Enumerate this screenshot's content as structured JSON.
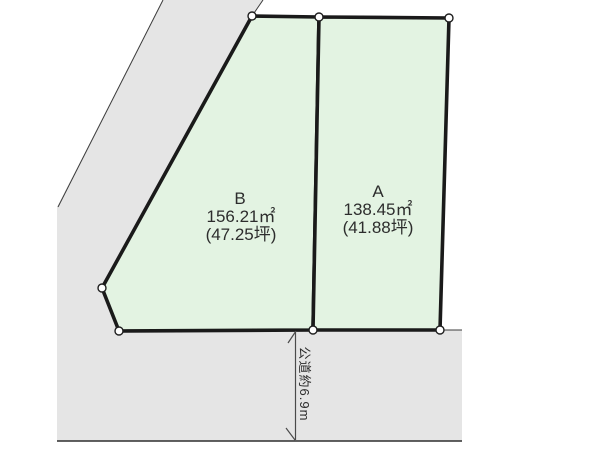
{
  "diagram": {
    "type": "land-plot-layout",
    "plots": [
      {
        "id": "B",
        "label": "B",
        "area_sqm": "156.21㎡",
        "area_tsubo": "(47.25坪)"
      },
      {
        "id": "A",
        "label": "A",
        "area_sqm": "138.45㎡",
        "area_tsubo": "(41.88坪)"
      }
    ],
    "road": {
      "label": "公道約6.9m"
    },
    "colors": {
      "plot_fill": "#e3f3e2",
      "road_fill": "#e5e5e5",
      "outline": "#1a1a1a",
      "background": "#ffffff",
      "text": "#2d2d2d"
    }
  }
}
